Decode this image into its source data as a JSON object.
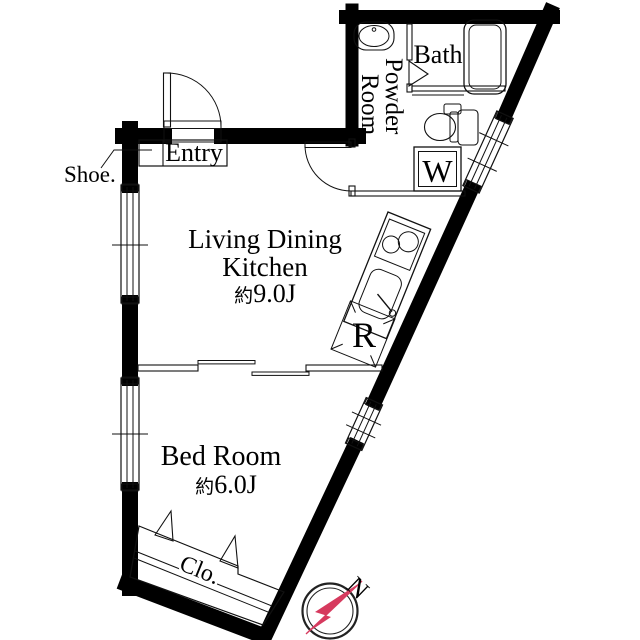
{
  "floor_plan": {
    "rooms": {
      "living_dining_kitchen": {
        "line1": "Living Dining",
        "line2": "Kitchen",
        "area_prefix": "約",
        "area_value": "9.0J"
      },
      "bed_room": {
        "name": "Bed Room",
        "area_prefix": "約",
        "area_value": "6.0J"
      },
      "bath": {
        "name": "Bath"
      },
      "powder_room": {
        "line1": "Powder",
        "line2": "Room"
      },
      "entry": {
        "name": "Entry"
      },
      "shoe_cabinet": {
        "label": "Shoe."
      },
      "closet": {
        "label": "Clo."
      }
    },
    "appliances": {
      "washing_machine_label": "W",
      "refrigerator_label": "R"
    },
    "compass": {
      "north_label": "N",
      "needle_color": "#d63a5e",
      "ring_color": "#222222"
    },
    "colors": {
      "wall": "#000000",
      "thin_line": "#111111",
      "background": "#ffffff"
    }
  }
}
